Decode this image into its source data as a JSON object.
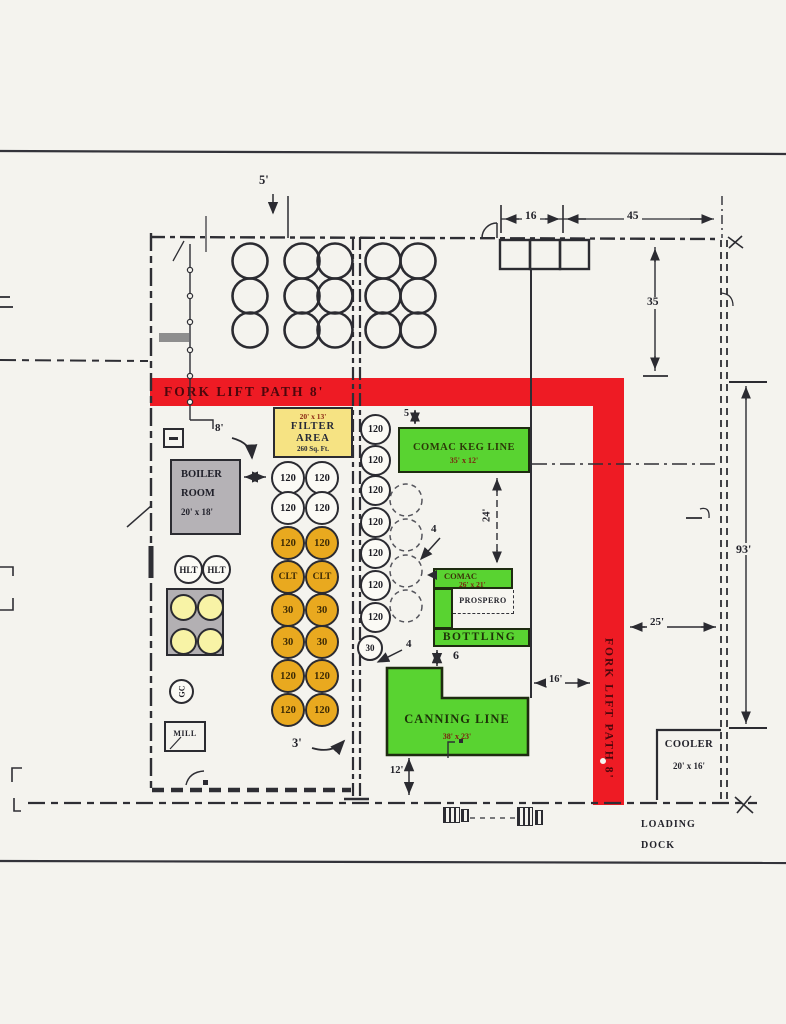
{
  "colors": {
    "path_red": "#ee1b24",
    "equipment_green": "#59d331",
    "filter_yellow": "#f6e383",
    "tank_amber": "#e9a91f",
    "room_gray": "#b5b2b6",
    "pale_yellow": "#f8f3a6",
    "line": "#2e2e34",
    "paper": "#f4f3ee"
  },
  "paths": {
    "horizontal": "FORK LIFT PATH 8'",
    "vertical": "FORK LIFT PATH 8'"
  },
  "rooms": {
    "boiler": {
      "line1": "BOILER",
      "line2": "ROOM",
      "size": "20' x 18'"
    },
    "filter": {
      "size": "20' x 13'",
      "line1": "FILTER",
      "line2": "AREA",
      "area": "260 Sq. Ft."
    },
    "cooler": {
      "name": "COOLER",
      "size": "20' x 16'"
    },
    "mill": {
      "name": "MILL"
    },
    "loading_dock": {
      "line1": "LOADING",
      "line2": "DOCK"
    }
  },
  "equipment": {
    "keg_line": {
      "name": "COMAC KEG LINE",
      "size": "35' x 12'"
    },
    "comac": {
      "name": "COMAC",
      "size": "26' x 21'"
    },
    "prospero": {
      "name": "PROSPERO"
    },
    "bottling": {
      "name": "BOTTLING"
    },
    "canning": {
      "name": "CANNING LINE",
      "size": "38' x 23'"
    }
  },
  "tanks": {
    "pair_columns": {
      "rows": [
        {
          "label": "120",
          "type": "white"
        },
        {
          "label": "120",
          "type": "white"
        },
        {
          "label": "120",
          "type": "amber"
        },
        {
          "label": "CLT",
          "type": "amber"
        },
        {
          "label": "30",
          "type": "amber"
        },
        {
          "label": "30",
          "type": "amber"
        },
        {
          "label": "120",
          "type": "amber"
        },
        {
          "label": "120",
          "type": "amber"
        }
      ]
    },
    "right_column": {
      "labels": [
        "120",
        "120",
        "120",
        "120",
        "120",
        "120",
        "120"
      ],
      "small": "30"
    },
    "hot_liquor": [
      "HLT",
      "HLT"
    ],
    "gc": "GC"
  },
  "dimensions": {
    "door_top": "5'",
    "top_left": "16",
    "top_right": "45",
    "right_upper": "35",
    "boiler_gap": "8'",
    "keg_gap": "5",
    "keg_to_comac": "24'",
    "tank_gap_upper": "4",
    "tank_gap_lower": "4",
    "bottling_gap": "6",
    "bottling_wall": "16'",
    "aisle": "3'",
    "canning_bottom": "12'",
    "building_height": "93'",
    "path_to_wall": "25'"
  }
}
